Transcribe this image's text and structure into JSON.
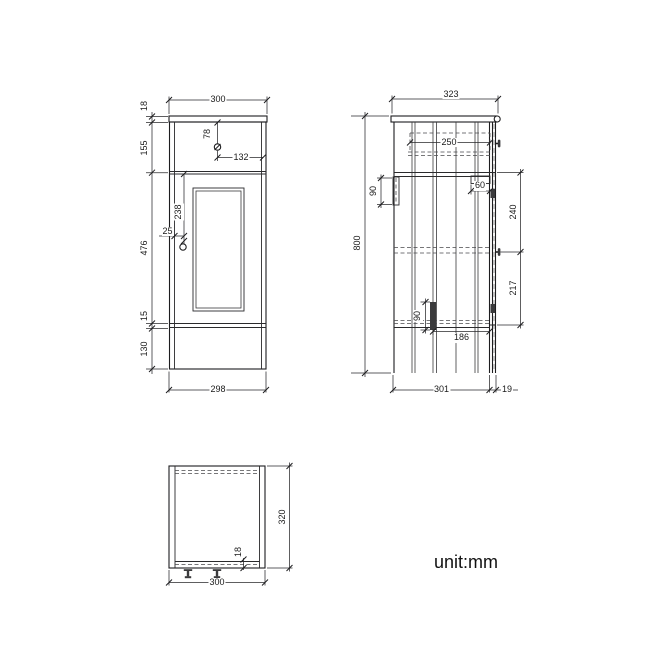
{
  "note": "unit:mm",
  "front_view": {
    "top_width": "300",
    "countertop_thickness": "18",
    "drawer_section_height": "155",
    "door_height": "476",
    "bottom_rail_height": "15",
    "plinth_height": "130",
    "drawer_knob_offset_top": "78",
    "drawer_knob_offset_right": "132",
    "door_knob_offset_top": "238",
    "door_knob_offset_left": "25",
    "bottom_width": "298"
  },
  "side_view": {
    "top_depth": "323",
    "overall_height": "800",
    "drawer_box_depth": "250",
    "hinge_plate_width": "60",
    "door_knob_from_top": "240",
    "door_knob_to_bottom": "217",
    "back_bracket_height": "90",
    "door_stay_height": "90",
    "door_stay_offset": "186",
    "bottom_depth": "301",
    "door_thickness": "19"
  },
  "top_view": {
    "depth": "320",
    "back_rail_thickness": "18",
    "width": "300"
  }
}
